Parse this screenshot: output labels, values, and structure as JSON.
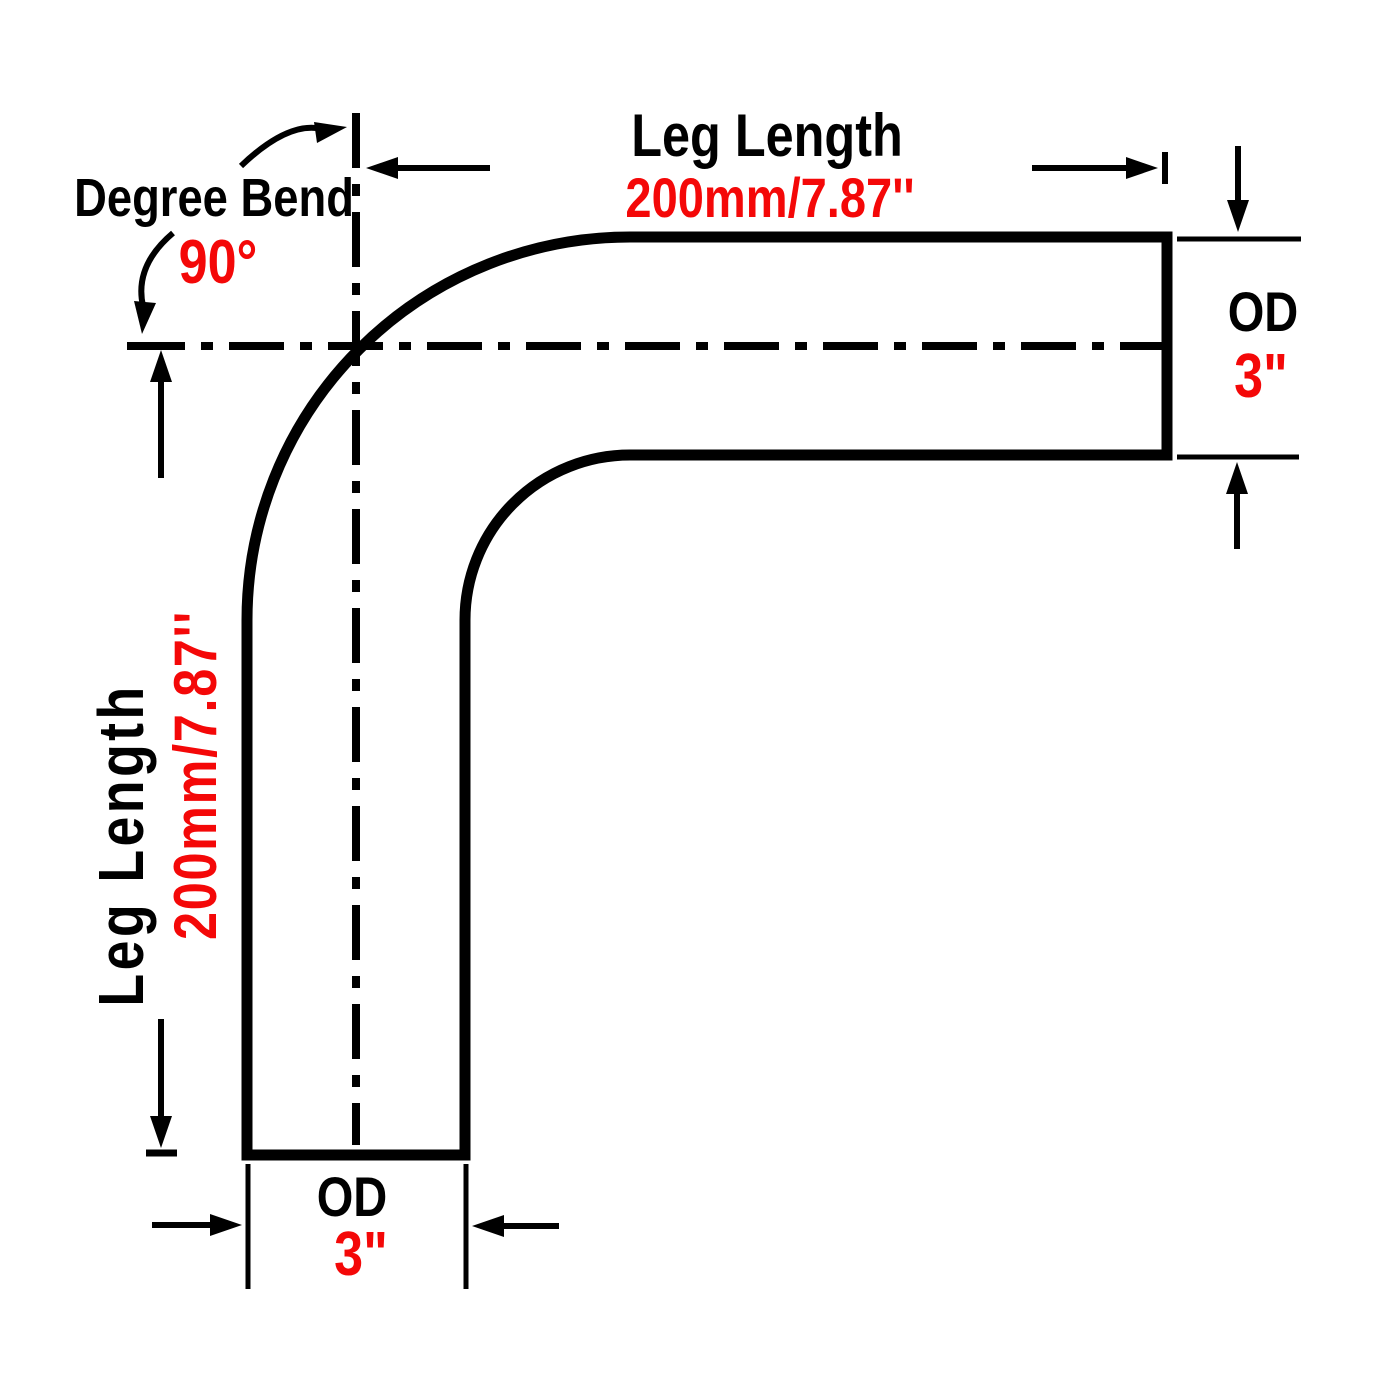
{
  "colors": {
    "line": "#000000",
    "accent_red": "#f40808",
    "background": "#ffffff"
  },
  "callouts": {
    "degree_bend": {
      "label": "Degree Bend",
      "value": "90°"
    },
    "top_leg": {
      "label": "Leg Length",
      "value": "200mm/7.87''"
    },
    "left_leg": {
      "label": "Leg Length",
      "value": "200mm/7.87''"
    },
    "right_od": {
      "label": "OD",
      "value": "3\""
    },
    "bottom_od": {
      "label": "OD",
      "value": "3\""
    }
  }
}
